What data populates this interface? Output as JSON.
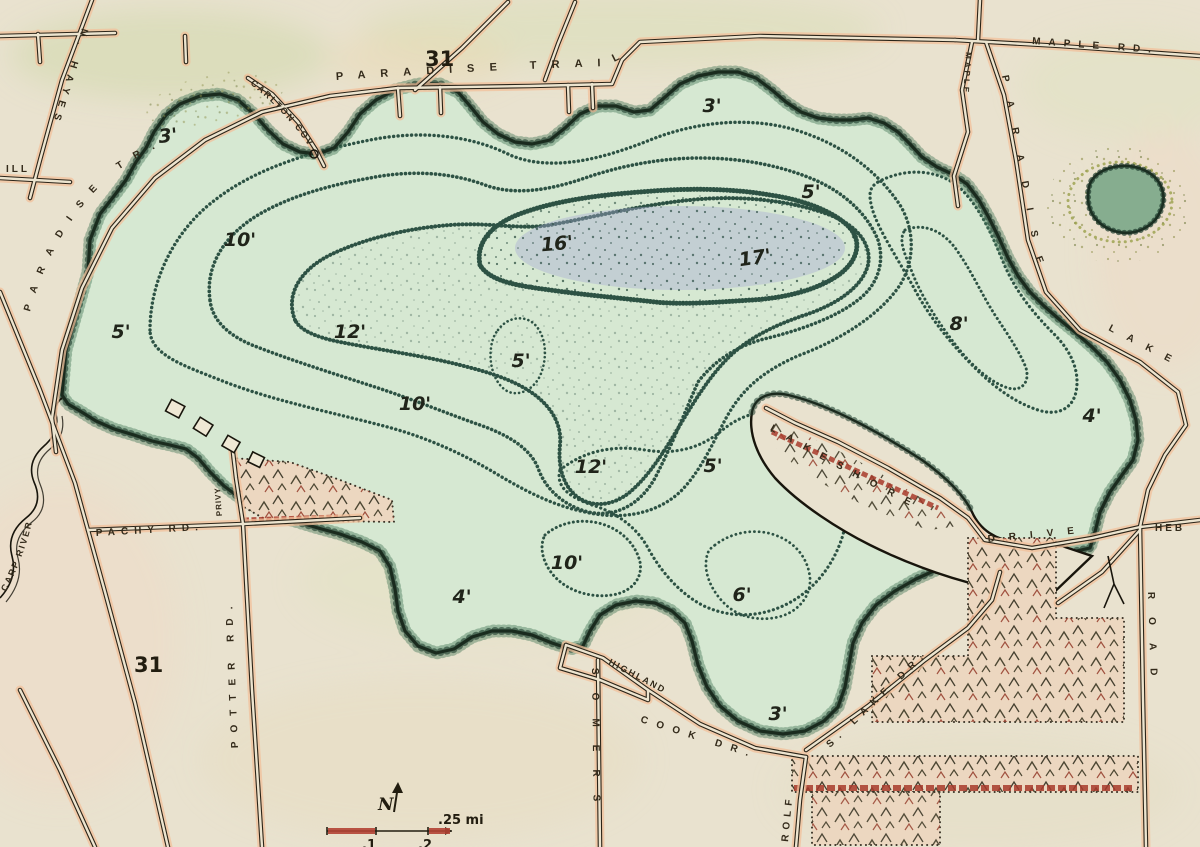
{
  "map": {
    "highway_shields": {
      "top": "31",
      "bottom": "31"
    },
    "road_labels": {
      "paradise_trail": "PARADISE TRAIL",
      "maple_rd": "MAPLE RD.",
      "maple_spur": "MAPLE",
      "paradise_lake_road_seg1": "PARADISE",
      "paradise_lake_road_seg2": "LAKE",
      "paradise_lake_road_seg3": "ROAD",
      "carlton_cove": "CARLTON COVE",
      "n_hayes": "N. HAYES",
      "mill_partial": "ILL",
      "paradise_tr_west": "PARADISE TR.",
      "carp_river": "CARP RIVER",
      "pachy_rd": "PACHY RD.",
      "potter_rd": "POTTER RD.",
      "privy_lane": "PRIVY",
      "lakeshore": "LAKESHORE",
      "drive": "DRIVE",
      "heb_partial": "HEB",
      "highland": "HIGHLAND",
      "cook_dr": "COOK DR.",
      "s_lake_dr": "S. LAKE DR.",
      "somers": "SOMERS",
      "rolf": "ROLF"
    },
    "depth_labels": [
      "3'",
      "10'",
      "5'",
      "12'",
      "10'",
      "5'",
      "16'",
      "12'",
      "17'",
      "3'",
      "5'",
      "5'",
      "8'",
      "4'",
      "10'",
      "4'",
      "6'",
      "3'"
    ],
    "compass": {
      "north": "N"
    },
    "scale_bar": {
      "tick_1": ".1",
      "tick_2": ".2",
      "end_label": ".25 mi"
    }
  }
}
